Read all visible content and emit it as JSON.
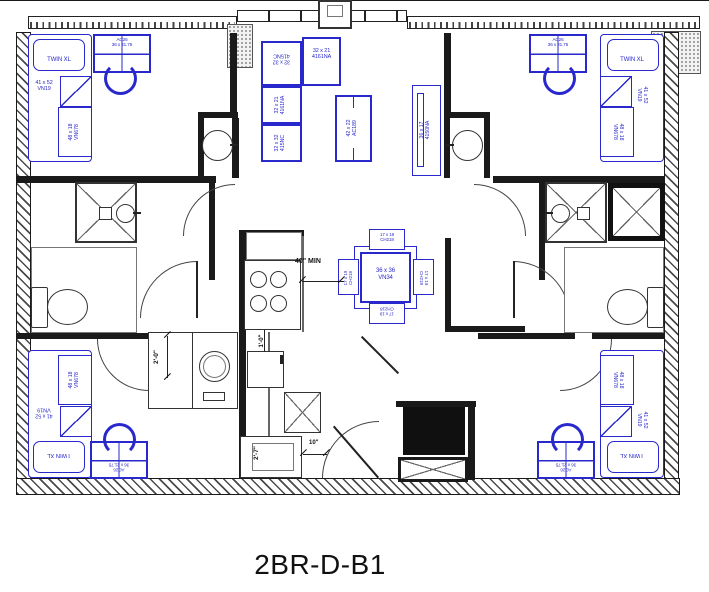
{
  "title": "2BR-D-B1",
  "labels": {
    "bed": "TWIN XL",
    "dresser": "41 x 52\nVN19",
    "wardrobe": "48 x 18\nVN678",
    "desk": "AC26\n36 x 21.75",
    "sofa_corner": "32 x 32\n415NC",
    "sofa_seat": "32 x 21\n4161NA",
    "console_table": "42 x 22\nAC189",
    "tv_panel": "36 x 17\n4150NA",
    "dining_table": "36 x 36\nVN34",
    "dining_chair": "17 x 19\nCH218"
  },
  "dimensions": {
    "clearance": "40\" MIN",
    "closet": "2'-0\"",
    "counter": "1'-0\"",
    "sink_cabinet": "2'-7\"",
    "door": "10\""
  },
  "colors": {
    "furniture": "#2828cc",
    "wall": "#1a1a1a"
  }
}
